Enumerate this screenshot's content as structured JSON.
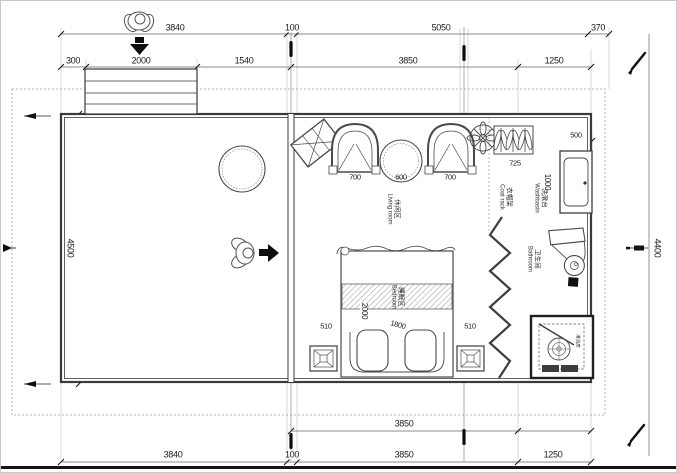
{
  "dimensions": {
    "top_outer": [
      "3840",
      "100",
      "5050",
      "370"
    ],
    "top_inner": [
      "300",
      "2000",
      "1540",
      "3850",
      "1250"
    ],
    "left_height": "4500",
    "right_height": "4400",
    "bottom_inner": "3850",
    "bottom_outer": [
      "3840",
      "100",
      "3850",
      "1250"
    ],
    "living_row": [
      "700",
      "600",
      "700"
    ],
    "coat_rack_width": "725",
    "washbasin_width": "500",
    "washbasin_depth": "1000",
    "bed_row": [
      "510",
      "1800",
      "510"
    ],
    "bed_length": "2000"
  },
  "labels": {
    "living": {
      "cn": "休闲区",
      "en": "Living room"
    },
    "bedroom": {
      "cn": "睡眠区",
      "en": "Bedroom"
    },
    "bathroom": {
      "cn": "卫生间",
      "en": "Bathroom"
    },
    "coat_rack": {
      "cn": "衣帽架",
      "en": "Coat rack"
    },
    "washbasin": {
      "cn": "洗漱台",
      "en": "Washbasin"
    },
    "shower": {
      "cn": "淋浴房"
    }
  }
}
